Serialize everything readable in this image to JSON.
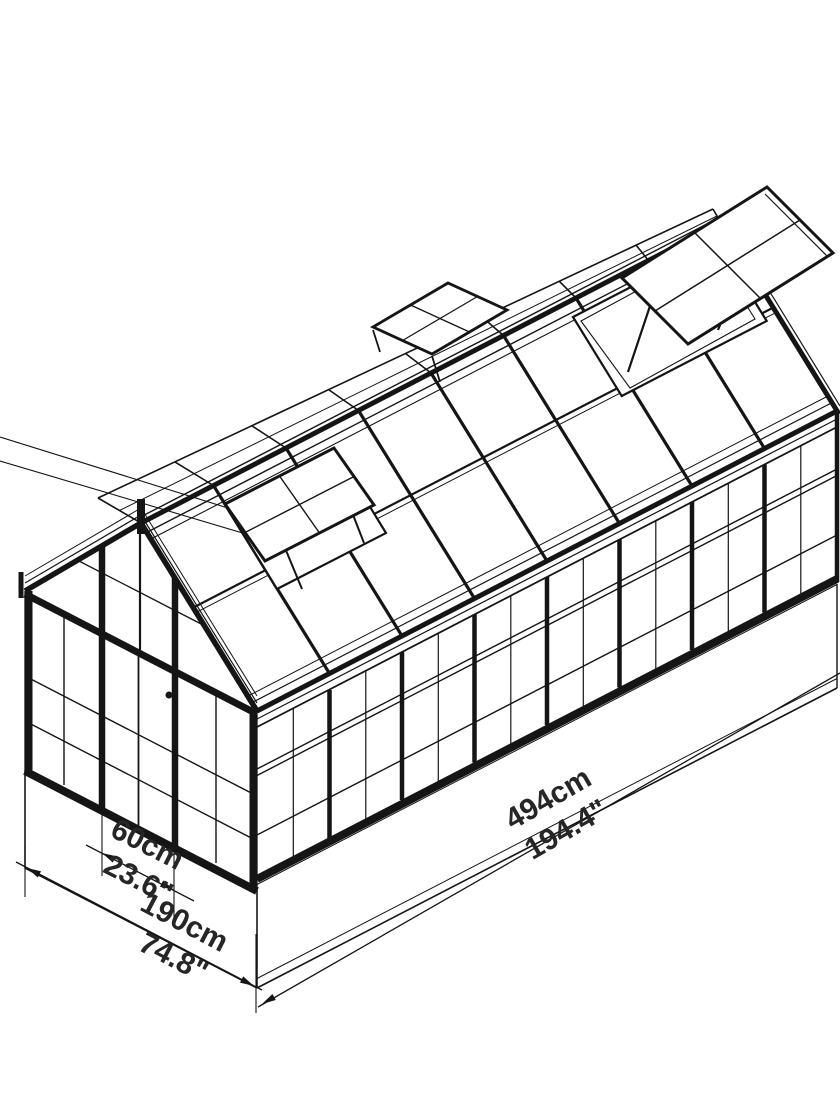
{
  "page": {
    "background": "#ffffff",
    "line_color": "#151515",
    "text_color": "#262626"
  },
  "drawing": {
    "subject": "greenhouse isometric dimension diagram",
    "dimensions": {
      "door_width": {
        "cm": "60cm",
        "inch": "23.6\""
      },
      "front_width": {
        "cm": "190cm",
        "inch": "74.8\""
      },
      "side_length": {
        "cm": "494cm",
        "inch": "194.4\""
      }
    }
  }
}
